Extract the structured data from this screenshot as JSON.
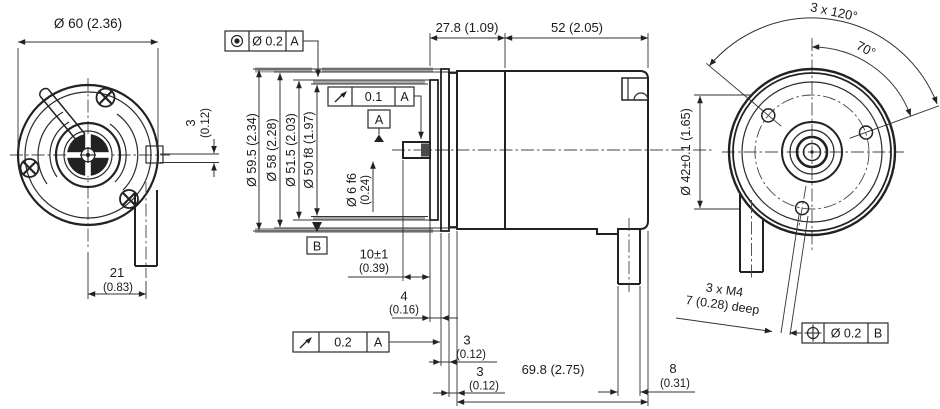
{
  "colors": {
    "line": "#1a1a1a",
    "surface_highlight": "#a9a9a9",
    "background": "#ffffff"
  },
  "front_view": {
    "dia_label": "Ø 60 (2.36)",
    "offset_label": "3",
    "offset_label_in": "(0.12)",
    "cable_offset_label": "21",
    "cable_offset_label_in": "(0.83)"
  },
  "side_view": {
    "length_front_label": "27.8 (1.09)",
    "length_rear_label": "52 (2.05)",
    "dia_flange_label": "Ø 59.5 (2.34)",
    "dia_body_label": "Ø 58 (2.28)",
    "dia_inner_label": "Ø 51.5 (2.03)",
    "dia_centering_label": "Ø 50 f8 (1.97)",
    "dia_shaft_label": "Ø 6 f6",
    "dia_shaft_label_in": "(0.24)",
    "shaft_length_label": "10±1",
    "shaft_length_label_in": "(0.39)",
    "step_label": "4",
    "step_label_in": "(0.16)",
    "plate1_label": "3",
    "plate1_label_in": "(0.12)",
    "plate2_label": "3",
    "plate2_label_in": "(0.12)",
    "body_length_label": "69.8 (2.75)",
    "cable_dia_label": "8",
    "cable_dia_label_in": "(0.31)",
    "datum_a": "A",
    "datum_b": "B",
    "fcf_concentricity": {
      "tolerance": "Ø 0.2",
      "datum": "A"
    },
    "fcf_runout_shaft": {
      "tolerance": "0.1",
      "datum": "A"
    },
    "fcf_runout_face": {
      "tolerance": "0.2",
      "datum": "A"
    }
  },
  "rear_view": {
    "hole_pattern_angle_label": "3 x 120°",
    "angle_label": "70°",
    "bolt_circle_label": "Ø 42±0.1 (1.65)",
    "thread_label": "3 x M4",
    "thread_depth_label": "7 (0.28) deep",
    "fcf_position": {
      "tolerance": "Ø 0.2",
      "datum": "B"
    }
  }
}
